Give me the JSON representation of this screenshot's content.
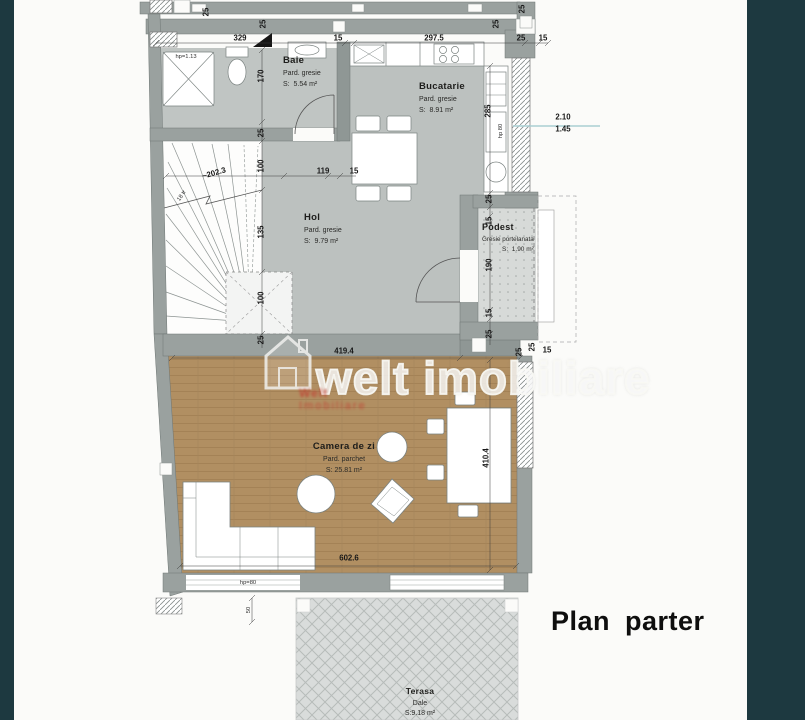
{
  "title": "Plan parter",
  "watermark": {
    "text": "welt imobiliare",
    "stamp_line1": "Welt",
    "stamp_line2": "Imobiliare"
  },
  "rooms": {
    "baie": {
      "name": "Baie",
      "floor": "Pard. gresie",
      "area": "S:  5.54 m²"
    },
    "bucatarie": {
      "name": "Bucatarie",
      "floor": "Pard. gresie",
      "area": "S:  8.91 m²"
    },
    "hol": {
      "name": "Hol",
      "floor": "Pard. gresie",
      "area": "S:  9.79 m²"
    },
    "podest": {
      "name": "Podest",
      "floor": "Gresie portelanata",
      "area": "S:  1.90 m²"
    },
    "camera_de_zi": {
      "name": "Camera de zi",
      "floor": "Pard. parchet",
      "area": "S: 25.81 m²"
    },
    "terasa": {
      "name": "Terasa",
      "floor": "Dale",
      "area": "S:9.18 m²"
    }
  },
  "colors": {
    "background_band": "#1d3940",
    "paper": "#fbfbf9",
    "wall_gray": "#9aa19f",
    "tile_floor": "#c0c5c3",
    "parquet_brown": "#b18f62",
    "terrace_gray": "#d9dcdb",
    "annotation_blue": "#a9cfd3",
    "stamp_red": "#c23b2e"
  },
  "dimensions": [
    {
      "text": "25",
      "x": 206,
      "y": 12,
      "rot": -90
    },
    {
      "text": "25",
      "x": 263,
      "y": 24,
      "rot": -90
    },
    {
      "text": "329",
      "x": 240,
      "y": 38
    },
    {
      "text": "15",
      "x": 338,
      "y": 38
    },
    {
      "text": "297.5",
      "x": 434,
      "y": 38
    },
    {
      "text": "25",
      "x": 521,
      "y": 38
    },
    {
      "text": "15",
      "x": 543,
      "y": 38
    },
    {
      "text": "25",
      "x": 496,
      "y": 24,
      "rot": -90
    },
    {
      "text": "25",
      "x": 522,
      "y": 9,
      "rot": -90
    },
    {
      "text": "hp=1.13",
      "x": 186,
      "y": 57,
      "small": true
    },
    {
      "text": "170",
      "x": 261,
      "y": 76,
      "rot": -90
    },
    {
      "text": "25",
      "x": 261,
      "y": 133,
      "rot": -90
    },
    {
      "text": "100",
      "x": 261,
      "y": 166,
      "rot": -90
    },
    {
      "text": "135",
      "x": 261,
      "y": 232,
      "rot": -90
    },
    {
      "text": "100",
      "x": 261,
      "y": 298,
      "rot": -90
    },
    {
      "text": "25",
      "x": 261,
      "y": 340,
      "rot": -90
    },
    {
      "text": "~202.3",
      "x": 214,
      "y": 173,
      "rot": -16
    },
    {
      "text": "18 tr",
      "x": 182,
      "y": 196,
      "rot": -55,
      "small": true
    },
    {
      "text": "119",
      "x": 323,
      "y": 171
    },
    {
      "text": "15",
      "x": 354,
      "y": 171
    },
    {
      "text": "285",
      "x": 488,
      "y": 111,
      "rot": -90
    },
    {
      "text": "hp 80",
      "x": 501,
      "y": 131,
      "rot": -90,
      "small": true
    },
    {
      "text": "2.10",
      "x": 563,
      "y": 117
    },
    {
      "text": "1.45",
      "x": 563,
      "y": 129
    },
    {
      "text": "25",
      "x": 489,
      "y": 199,
      "rot": -90
    },
    {
      "text": "15",
      "x": 489,
      "y": 221,
      "rot": -90
    },
    {
      "text": "190",
      "x": 489,
      "y": 265,
      "rot": -90
    },
    {
      "text": "15",
      "x": 489,
      "y": 313,
      "rot": -90
    },
    {
      "text": "25",
      "x": 489,
      "y": 334,
      "rot": -90
    },
    {
      "text": "419.4",
      "x": 344,
      "y": 351
    },
    {
      "text": "25",
      "x": 519,
      "y": 352,
      "rot": -90
    },
    {
      "text": "25",
      "x": 532,
      "y": 347,
      "rot": -90
    },
    {
      "text": "15",
      "x": 547,
      "y": 350
    },
    {
      "text": "410.4",
      "x": 486,
      "y": 458,
      "rot": -90
    },
    {
      "text": "602.6",
      "x": 349,
      "y": 558
    },
    {
      "text": "hp=80",
      "x": 248,
      "y": 583,
      "small": true
    },
    {
      "text": "50",
      "x": 249,
      "y": 610,
      "rot": -90,
      "small": true
    }
  ]
}
